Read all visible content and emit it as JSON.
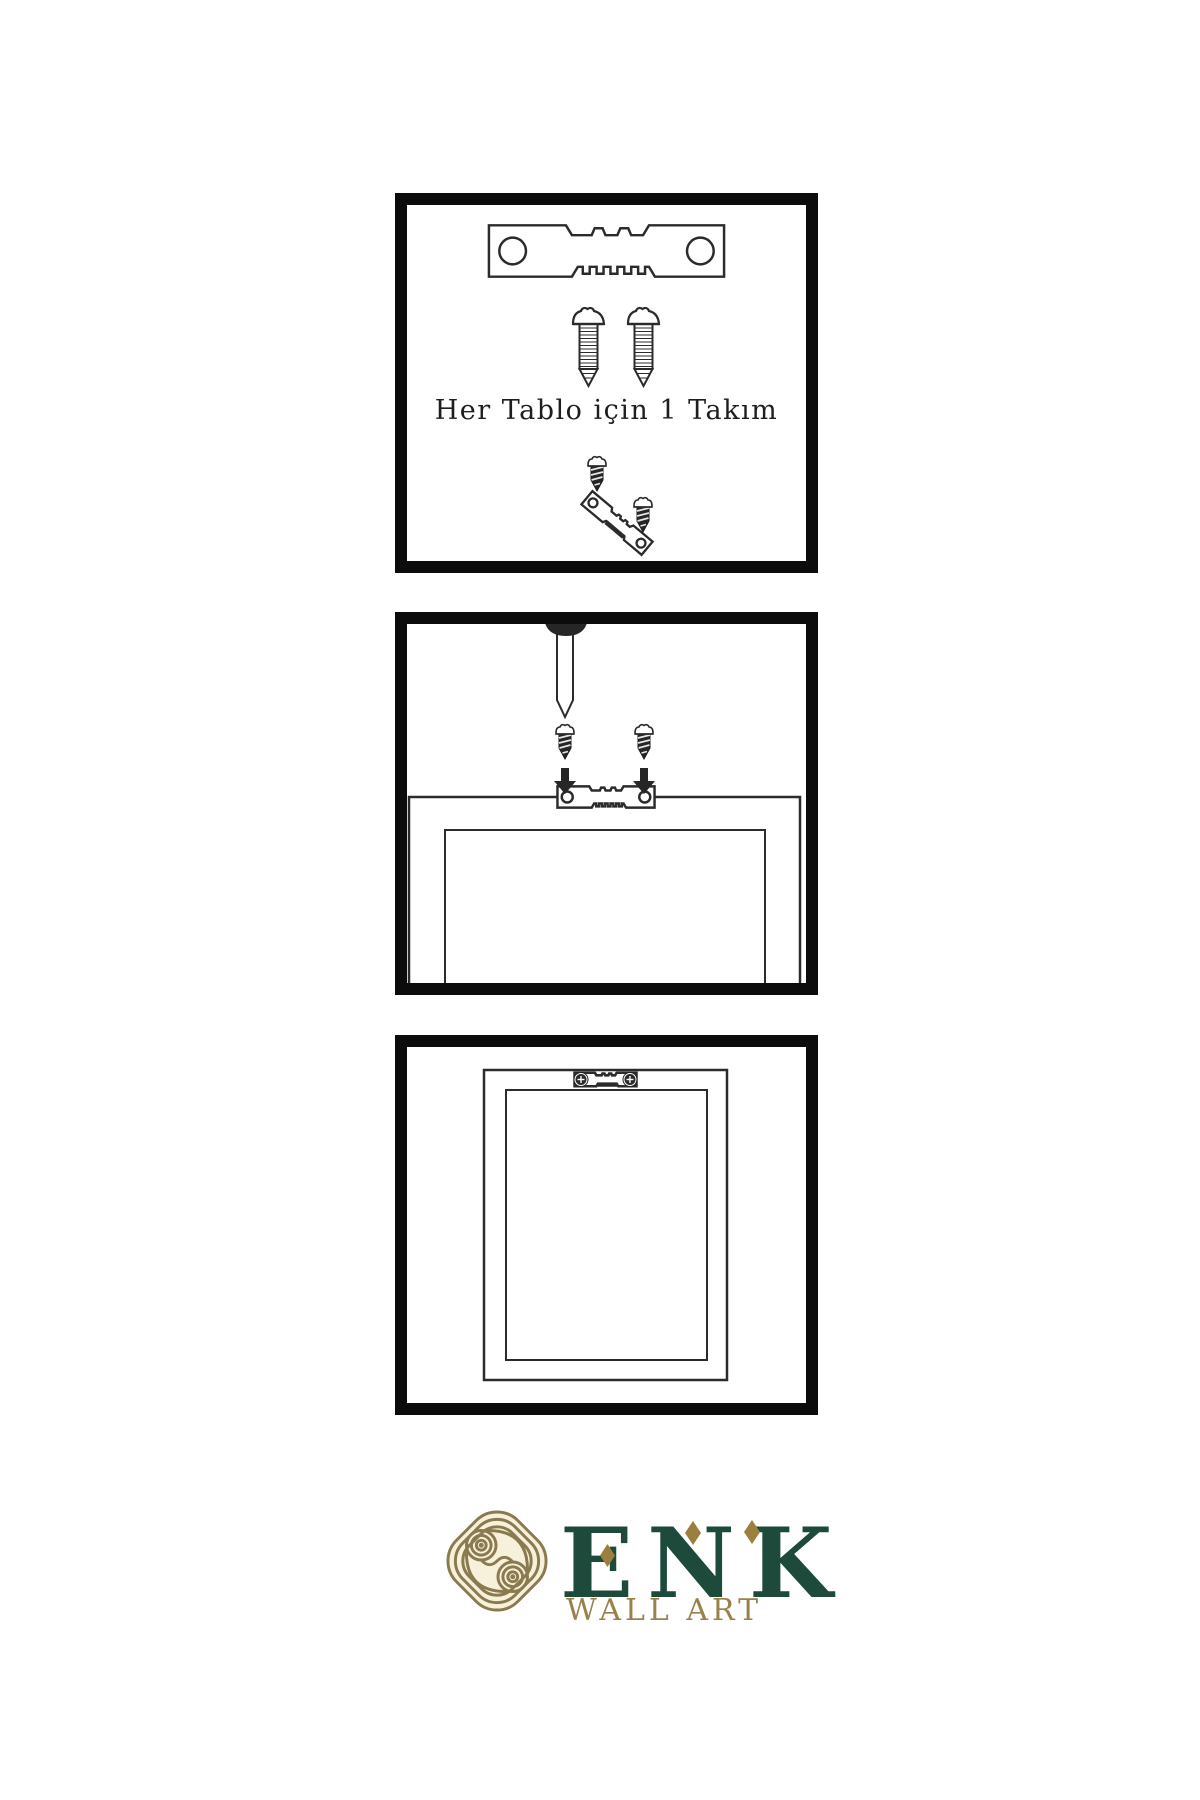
{
  "page": {
    "background": "#ffffff",
    "line_color": "#2b2b2b",
    "ink": "#262626",
    "panel_border_color": "#0c0c0c"
  },
  "panels": [
    {
      "name": "hardware-kit",
      "caption": "Her Tablo için 1 Takım",
      "items": [
        "sawtooth-hanger",
        "screw",
        "screw",
        "screw-and-angled-hanger"
      ]
    },
    {
      "name": "wall-installation",
      "items": [
        "nail-in-wall",
        "screw",
        "screw",
        "down-arrow",
        "down-arrow",
        "frame-back-with-sawtooth-hanger"
      ]
    },
    {
      "name": "mounted-frame",
      "items": [
        "frame-with-sawtooth-hanger-screwed"
      ]
    }
  ],
  "logo": {
    "title": "ENK",
    "subtitle": "WALL ART",
    "colors": {
      "title_green": "#1d4a3a",
      "subtitle_gold": "#99814a",
      "diamond_gold": "#9a7f3e",
      "knot_gold": "#8a7a50",
      "knot_cream": "#f7f0da"
    }
  }
}
